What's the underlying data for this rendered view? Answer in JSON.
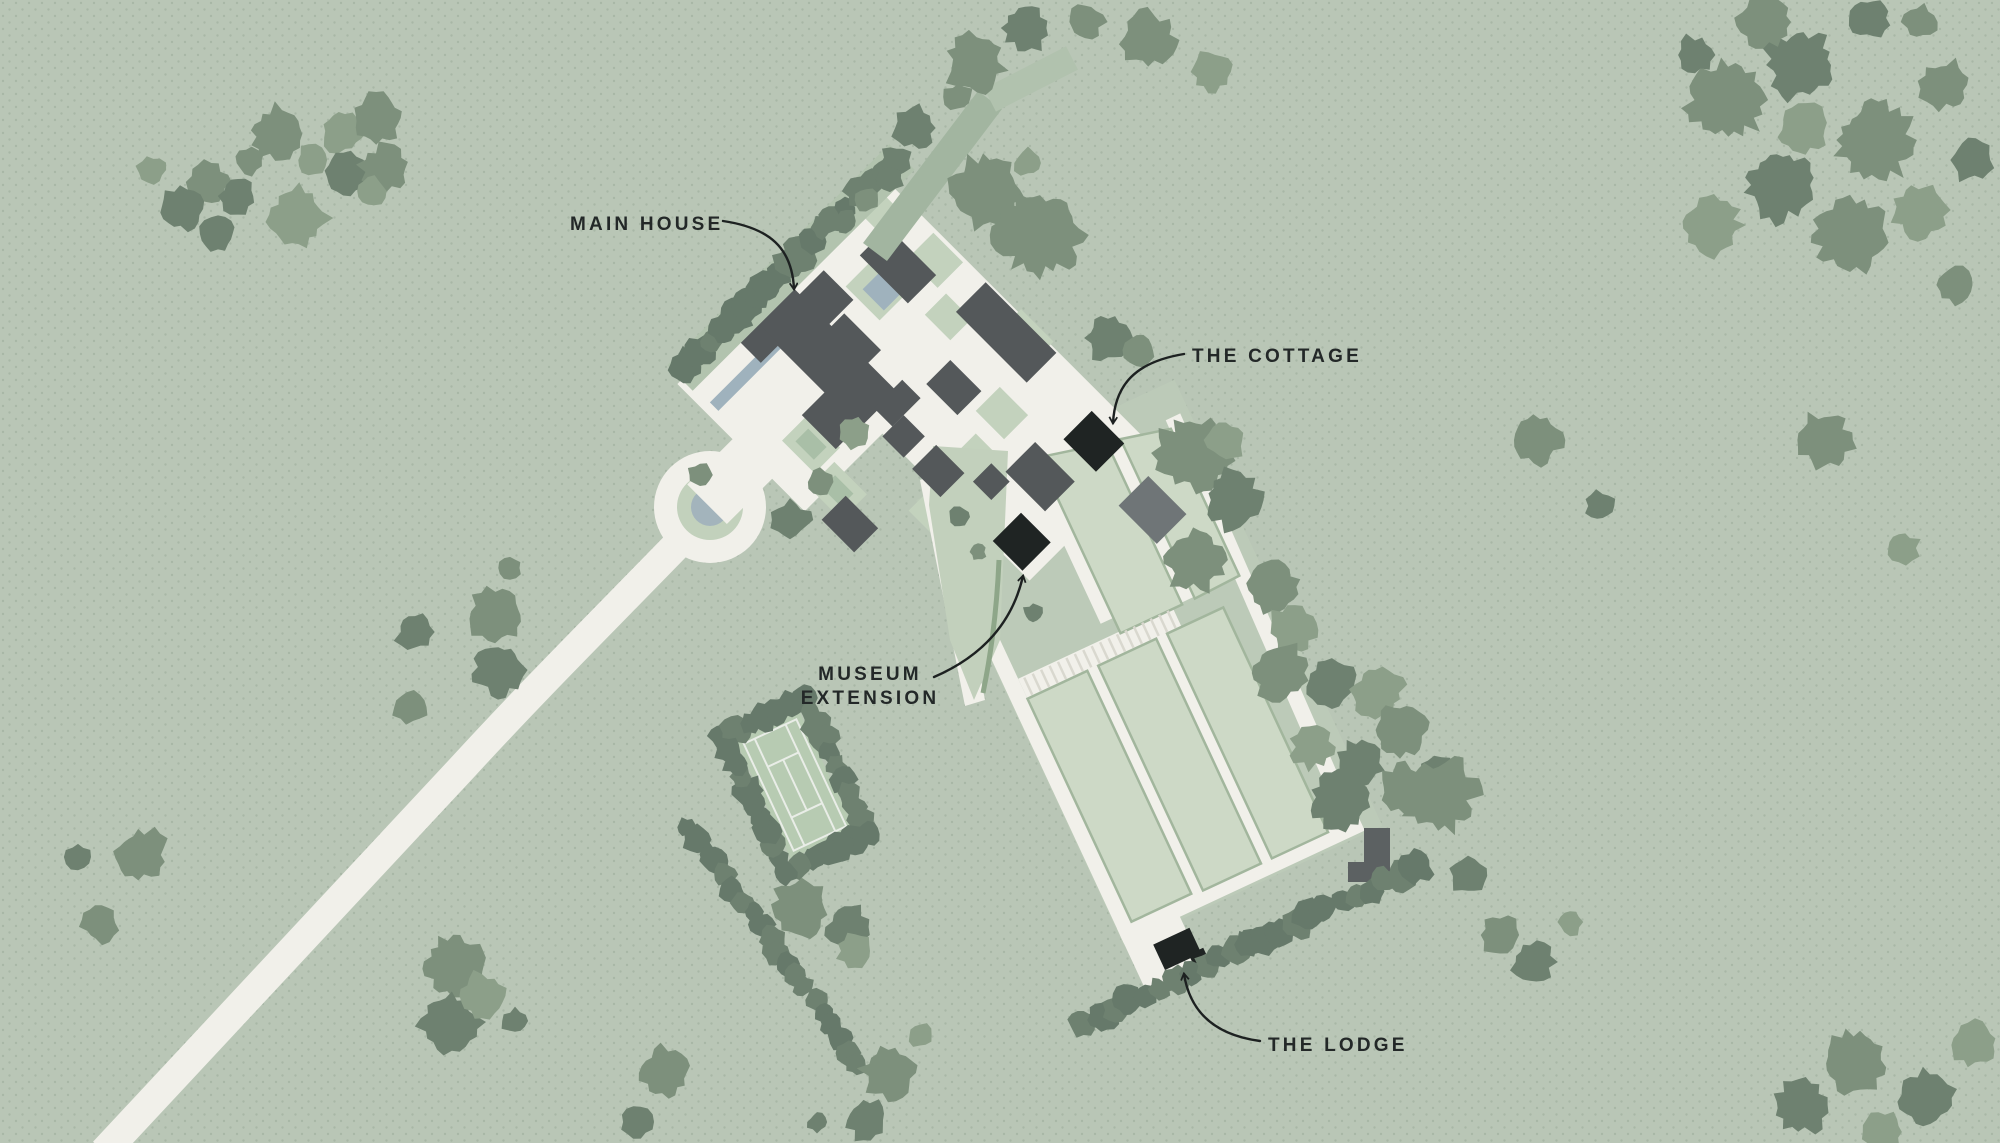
{
  "map": {
    "type": "estate-site-plan",
    "labels": {
      "main_house": "MAIN HOUSE",
      "the_cottage": "THE COTTAGE",
      "museum_extension_line1": "MUSEUM",
      "museum_extension_line2": "EXTENSION",
      "the_lodge": "THE LODGE"
    },
    "features": [
      "Main House",
      "The Cottage",
      "Museum Extension",
      "The Lodge"
    ],
    "palette": {
      "background": "#b9c6b6",
      "dots": "#97a896",
      "path": "#f1f0ea",
      "building_dark": "#54585a",
      "building_black": "#1f2423",
      "building_gray": "#6f7577",
      "parcel_green": "#cdd9c6",
      "lawn_green": "#c2d0bc",
      "hedge_green": "#66796a",
      "tree_dark": "#6e8170",
      "tree_mid": "#7d907c",
      "tree_light": "#8c9f89",
      "water_blue": "#9fb2bd",
      "label_text": "#232828"
    }
  }
}
